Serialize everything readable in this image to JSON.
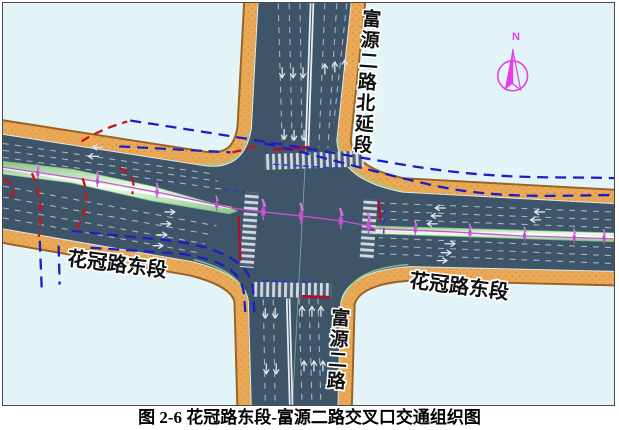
{
  "figure": {
    "caption": "图 2-6  花冠路东段-富源二路交叉口交通组织图"
  },
  "map": {
    "labels": {
      "north_approach": "富源二路北延段",
      "south_approach": "富源二路",
      "west_approach": "花冠路东段",
      "east_approach": "花冠路东段"
    },
    "compass": {
      "north_label": "N"
    },
    "colors": {
      "background": "#e2f4f7",
      "road": "#3e5468",
      "sidewalk": "#eaa957",
      "median_green": "#bfe6bf",
      "flow_blue": "#1d1dc8",
      "flow_red": "#cc1111",
      "centerline_magenta": "#cf4fcf",
      "stop_line_red": "#ab1233",
      "compass_magenta": "#e23ee2"
    }
  }
}
